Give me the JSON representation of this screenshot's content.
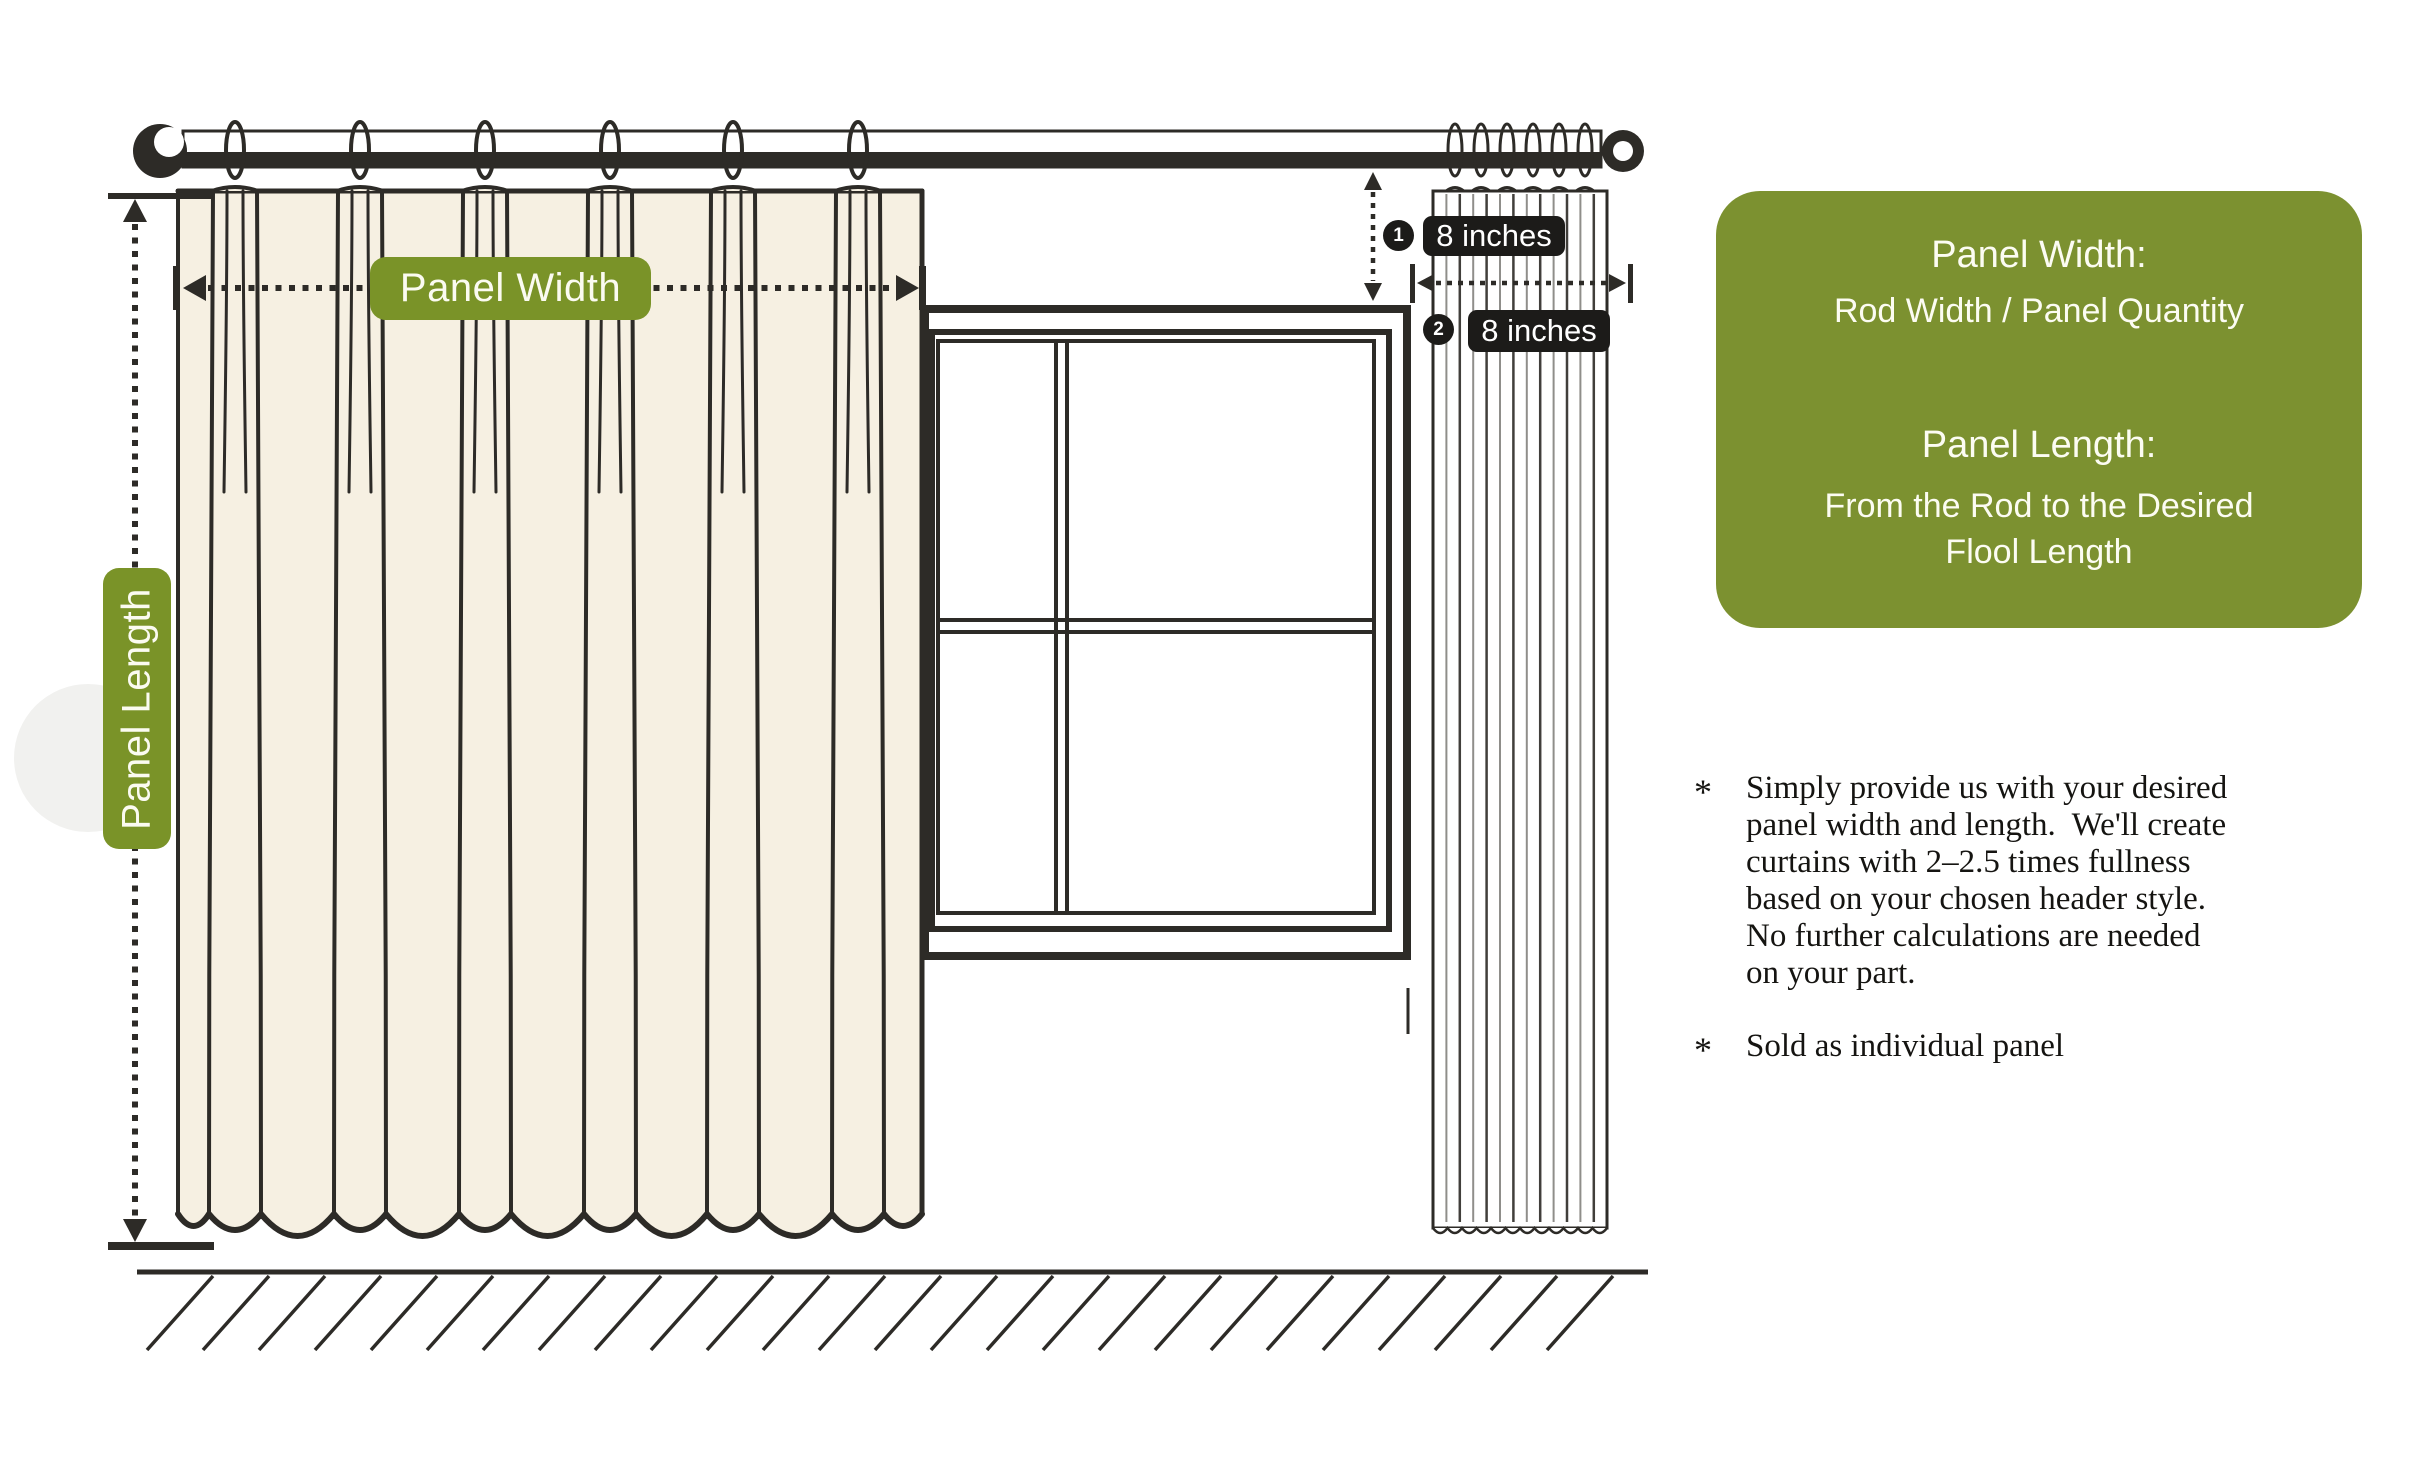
{
  "colors": {
    "green": "#7c9130",
    "green_pill": "#7a9328",
    "ink": "#2d2b27",
    "badge_black": "#1c1b19",
    "curtain_cream": "#f6f0e2"
  },
  "labels": {
    "panel_width": "Panel Width",
    "panel_length": "Panel Length"
  },
  "measurements": [
    {
      "number": "1",
      "text": "8 inches"
    },
    {
      "number": "2",
      "text": "8 inches"
    }
  ],
  "info_box": {
    "width_title": "Panel Width:",
    "width_value": "Rod Width / Panel Quantity",
    "length_title": "Panel Length:",
    "length_value": "From the Rod to the Desired\nFlool Length"
  },
  "notes": [
    {
      "marker": "*",
      "text": "Simply provide us with your desired\npanel width and length.  We'll create\ncurtains with 2–2.5 times fullness\nbased on your chosen header style.\nNo further calculations are needed\non your part."
    },
    {
      "marker": "*",
      "text": "Sold as individual panel"
    }
  ]
}
